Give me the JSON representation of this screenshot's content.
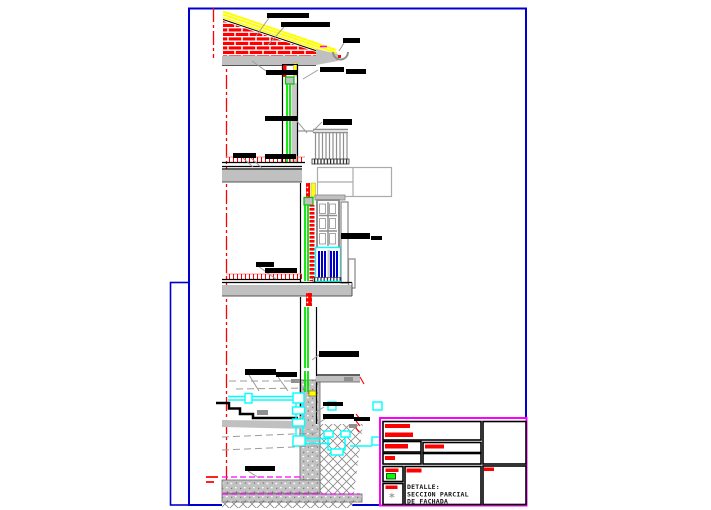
{
  "app": {
    "background": "#ffffff"
  },
  "palette": {
    "frame_blue": "#0000cd",
    "magenta": "#ff00ff",
    "red": "#ff0000",
    "green": "#00e400",
    "yellow": "#ffff00",
    "cyan": "#00ffff",
    "shutter_blue": "#0000cc",
    "slab_gray": "#c0c0c0",
    "line_gray": "#8f8f8f",
    "leader_gray": "#9c9c9c"
  },
  "title_block": {
    "detail_title": {
      "line1": "DETALLE:",
      "line2": "SECCION PARCIAL",
      "line3": "DE FACHADA"
    },
    "legend_swatch_color": "#00ff00",
    "legend_symbol": "*",
    "redacted_fields": [
      [
        385,
        424,
        25,
        4
      ],
      [
        385,
        432.5,
        28,
        4.5
      ],
      [
        385,
        444,
        23,
        4.5
      ],
      [
        425,
        444.5,
        19,
        4
      ],
      [
        385,
        456,
        10,
        4
      ],
      [
        385.5,
        468.5,
        13,
        3.5
      ],
      [
        406.5,
        468.5,
        15,
        4
      ],
      [
        385.5,
        485.5,
        12,
        3.5
      ],
      [
        484,
        467.5,
        10,
        3.5
      ]
    ]
  },
  "annotations": {
    "redacted_labels": [
      [
        267,
        13,
        42,
        5
      ],
      [
        281,
        22,
        49,
        5
      ],
      [
        343,
        38,
        17,
        5
      ],
      [
        266,
        70,
        31,
        5
      ],
      [
        320,
        67,
        24,
        5
      ],
      [
        346,
        69,
        20,
        5
      ],
      [
        265,
        116,
        32,
        5
      ],
      [
        323,
        119,
        29,
        6
      ],
      [
        233,
        153,
        23,
        5
      ],
      [
        265,
        154,
        31,
        5
      ],
      [
        341,
        233,
        29,
        6
      ],
      [
        371,
        236,
        11,
        4
      ],
      [
        256,
        262,
        18,
        5
      ],
      [
        265,
        268,
        32,
        5
      ],
      [
        319,
        351,
        40,
        6
      ],
      [
        245,
        369,
        31,
        6
      ],
      [
        276,
        372,
        21,
        5
      ],
      [
        323,
        402,
        20,
        4
      ],
      [
        323,
        414,
        31,
        5
      ],
      [
        354,
        417,
        16,
        4
      ],
      [
        245,
        466,
        30,
        5
      ]
    ],
    "leader_lines": [
      [
        269,
        18,
        256,
        36
      ],
      [
        284,
        27,
        268,
        45
      ],
      [
        344,
        43,
        339,
        51
      ],
      [
        252,
        61,
        266,
        71
      ],
      [
        318,
        70,
        303,
        79
      ],
      [
        296,
        120,
        307,
        133
      ],
      [
        322,
        122,
        312,
        132
      ],
      [
        243,
        158,
        253,
        167
      ],
      [
        251,
        158,
        262,
        168
      ],
      [
        341,
        236,
        338,
        239
      ],
      [
        258,
        266,
        269,
        274
      ],
      [
        266,
        272,
        276,
        279
      ],
      [
        249,
        375,
        259,
        391
      ],
      [
        278,
        377,
        288,
        391
      ],
      [
        320,
        354,
        312,
        360
      ],
      [
        324,
        407,
        316,
        412
      ],
      [
        325,
        419,
        317,
        424
      ],
      [
        248,
        471,
        259,
        478
      ]
    ],
    "construction_dashed_lines": [
      [
        229,
        381,
        299,
        381
      ],
      [
        236,
        389,
        306,
        388
      ],
      [
        222,
        437,
        317,
        433
      ],
      [
        222,
        450,
        317,
        446
      ]
    ],
    "ground_magenta_lines": [
      [
        222,
        477,
        304,
        477
      ],
      [
        222,
        494,
        360,
        494
      ]
    ]
  }
}
